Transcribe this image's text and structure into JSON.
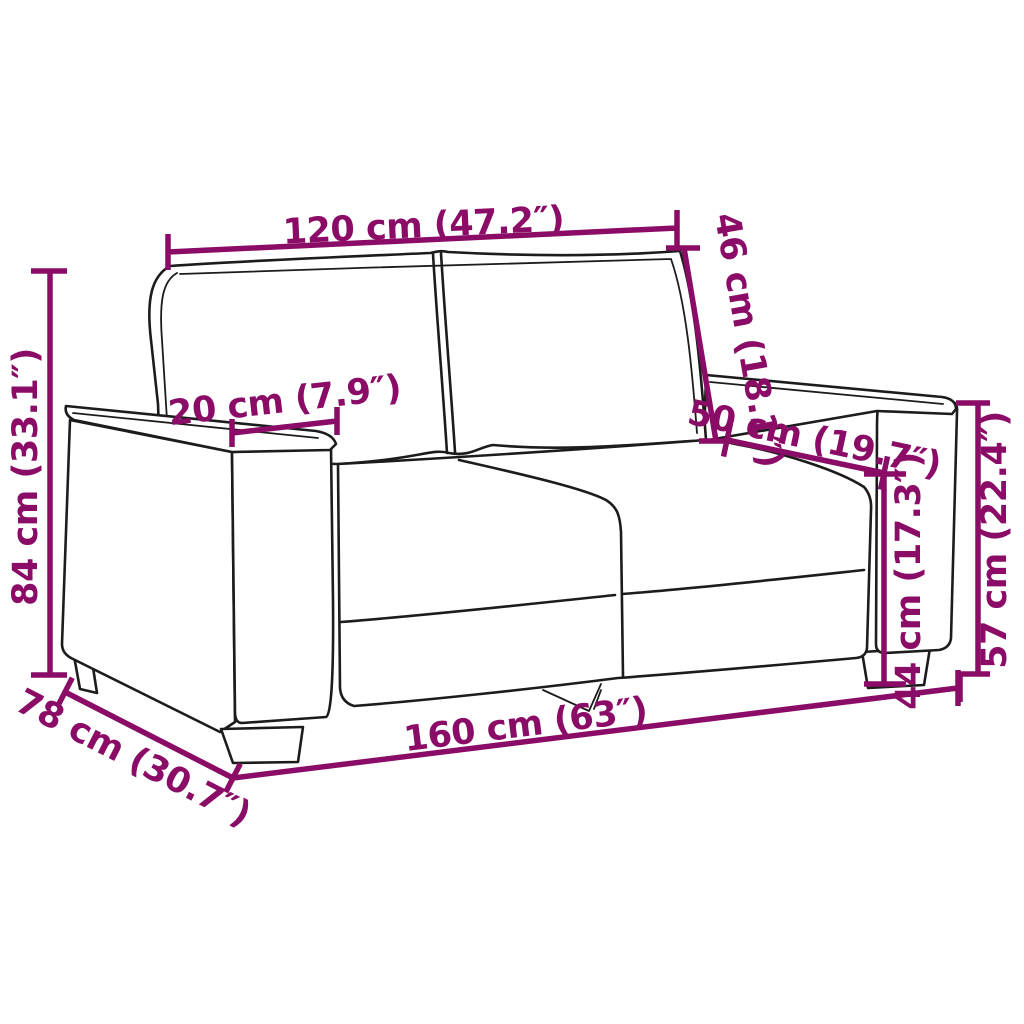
{
  "diagram": {
    "title": "Sofa dimension diagram",
    "subject": "two-seater sofa line drawing with measurements",
    "colors": {
      "dimension": "#8A0C66",
      "line_art": "#1C1C1C",
      "background": "#FFFFFF"
    },
    "measurements": {
      "back_width": "120 cm (47.2″)",
      "back_cushion_height": "46 cm (18.1″)",
      "armrest_width": "20 cm (7.9″)",
      "seat_depth": "50 cm (19.7″)",
      "total_height": "84 cm (33.1″)",
      "seat_height": "44 cm (17.3″)",
      "armrest_height": "57 cm (22.4″)",
      "total_depth": "78 cm (30.7″)",
      "total_width": "160 cm (63″)"
    }
  }
}
